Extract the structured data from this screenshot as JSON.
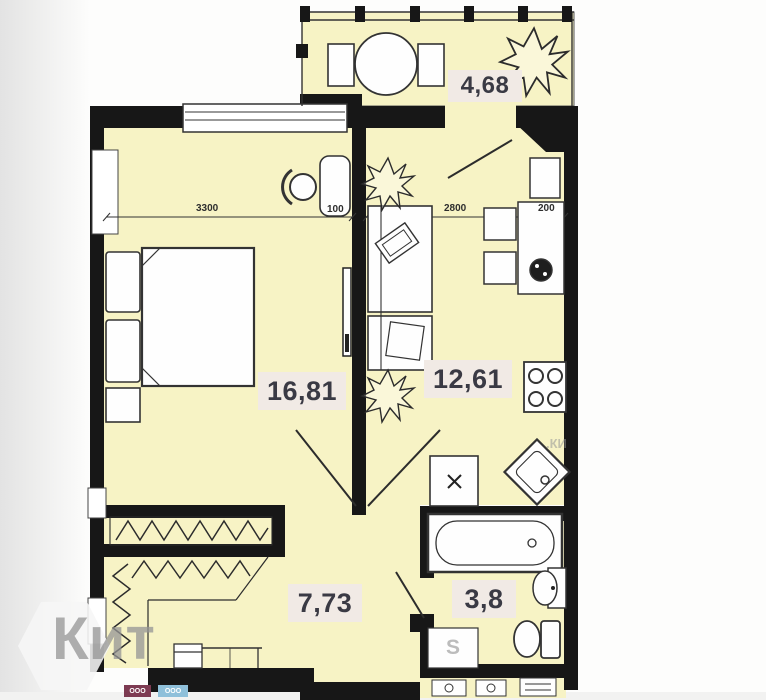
{
  "plan": {
    "rooms": [
      {
        "name": "balcony",
        "area": "4,68"
      },
      {
        "name": "living-room",
        "area": "16,81"
      },
      {
        "name": "kitchen",
        "area": "12,61"
      },
      {
        "name": "hallway",
        "area": "7,73"
      },
      {
        "name": "bathroom",
        "area": "3,8"
      }
    ],
    "dimensions": [
      {
        "name": "living-room-width-mm",
        "value": "3300"
      },
      {
        "name": "wall-offset-mm",
        "value": "100"
      },
      {
        "name": "kitchen-width-mm",
        "value": "2800"
      },
      {
        "name": "kitchen-offset-mm",
        "value": "200"
      }
    ],
    "fixture_labels": {
      "storage": "S"
    }
  },
  "watermarks": {
    "agency_logo_text": "Кит",
    "corner_text": ".КИ",
    "badge_left_text": "ООО",
    "badge_right_text": "ООО"
  },
  "colors": {
    "floor_fill": "#f7f3c5",
    "wall": "#171717",
    "area_label_bg": "#f1eae5",
    "area_label_text": "#3a3a44",
    "badge_left_bg": "#7d3b52",
    "badge_right_bg": "#8fc0da"
  }
}
